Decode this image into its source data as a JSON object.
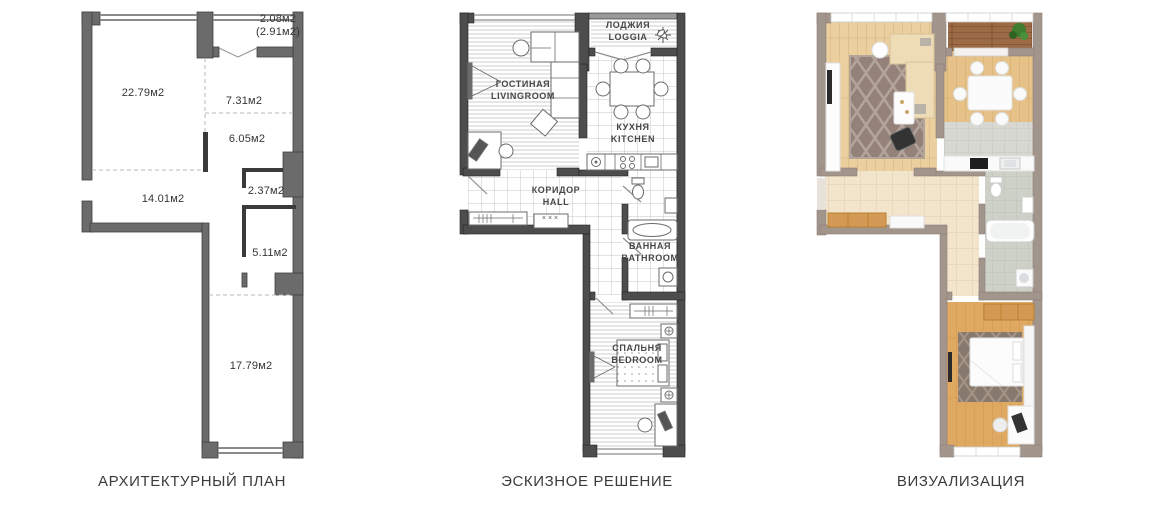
{
  "captions": {
    "architectural": "АРХИТЕКТУРНЫЙ ПЛАН",
    "sketch": "ЭСКИЗНОЕ РЕШЕНИЕ",
    "visualization": "ВИЗУАЛИЗАЦИЯ"
  },
  "architectural_plan": {
    "areas": {
      "loggia_net": "2.08м2",
      "loggia_gross": "(2.91м2)",
      "living_room": "22.79м2",
      "corridor_upper": "7.31м2",
      "corridor_lower": "6.05м2",
      "closet": "2.37м2",
      "hall": "14.01м2",
      "storage_room": "5.11м2",
      "bedroom": "17.79м2"
    }
  },
  "sketch_plan": {
    "rooms": {
      "loggia": {
        "ru": "ЛОДЖИЯ",
        "en": "LOGGIA"
      },
      "living_room": {
        "ru": "ГОСТИНАЯ",
        "en": "LIVINGROOM"
      },
      "kitchen": {
        "ru": "КУХНЯ",
        "en": "KITCHEN"
      },
      "hall": {
        "ru": "КОРИДОР",
        "en": "HALL"
      },
      "bathroom": {
        "ru": "ВАННАЯ",
        "en": "BATHROOM"
      },
      "bedroom": {
        "ru": "СПАЛЬНЯ",
        "en": "BEDROOM"
      }
    },
    "shoe_rack_marks": "×××"
  },
  "visualization": {},
  "colors": {
    "plan_wall_gray": "#6b6b6b",
    "sketch_wall_dark": "#4d4d4d",
    "viz_wall_taupe": "#a2958c",
    "wood_light": "#ebcf9f",
    "wood_dark": "#dfa962",
    "loggia_wood": "#9c6a45",
    "kitchen_tile_gray": "#d8d8d2",
    "hall_tile_beige": "#f2e5cb",
    "bath_tile_gray": "#cdd1c7",
    "rug_brown": "#94827a",
    "sofa_cream": "#eddcb6",
    "wardrobe_wood": "#d49a55",
    "plant_green": "#3e7d2e"
  }
}
